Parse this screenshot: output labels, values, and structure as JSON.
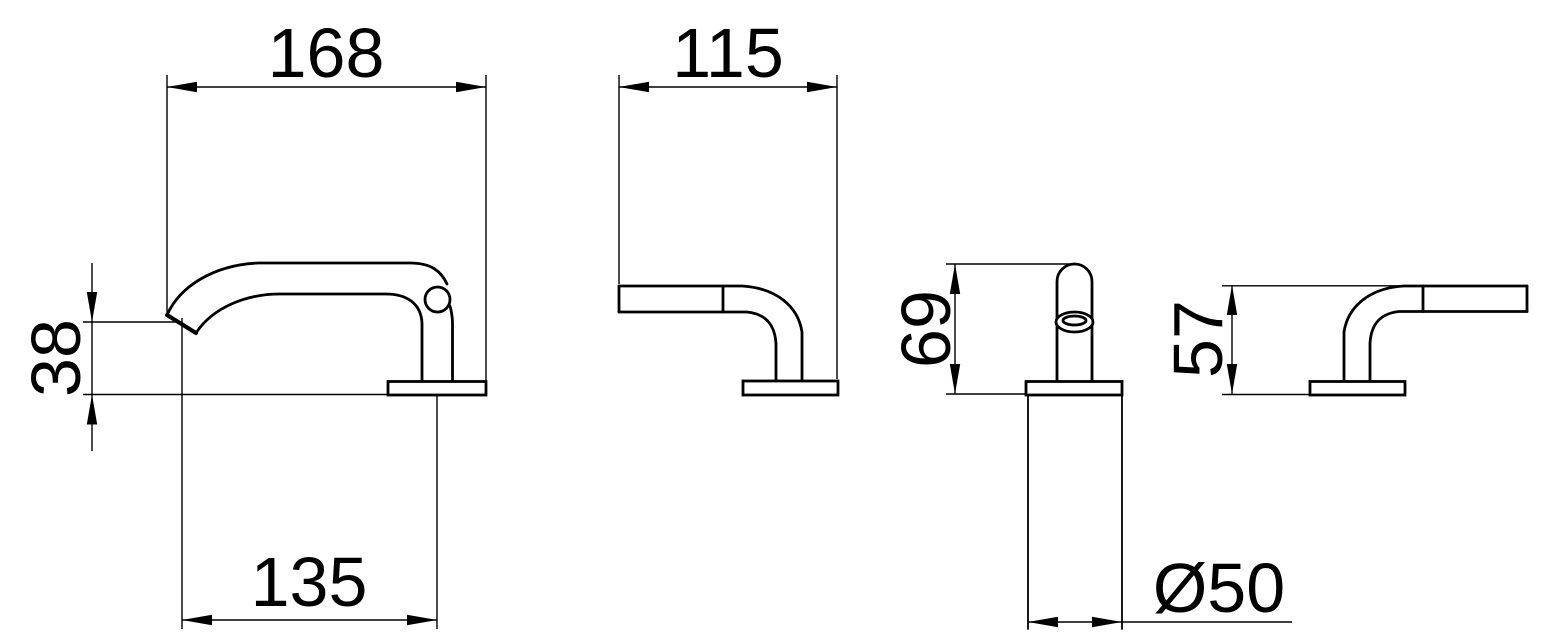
{
  "colors": {
    "background": "#ffffff",
    "lines": "#000000",
    "text": "#000000"
  },
  "dimensions": {
    "spout": {
      "length": "168",
      "reach": "135",
      "outlet_height": "38"
    },
    "handle_left": {
      "length": "115"
    },
    "handle_front": {
      "height": "69",
      "base_diameter": "Ø50"
    },
    "handle_right": {
      "height": "57"
    }
  }
}
